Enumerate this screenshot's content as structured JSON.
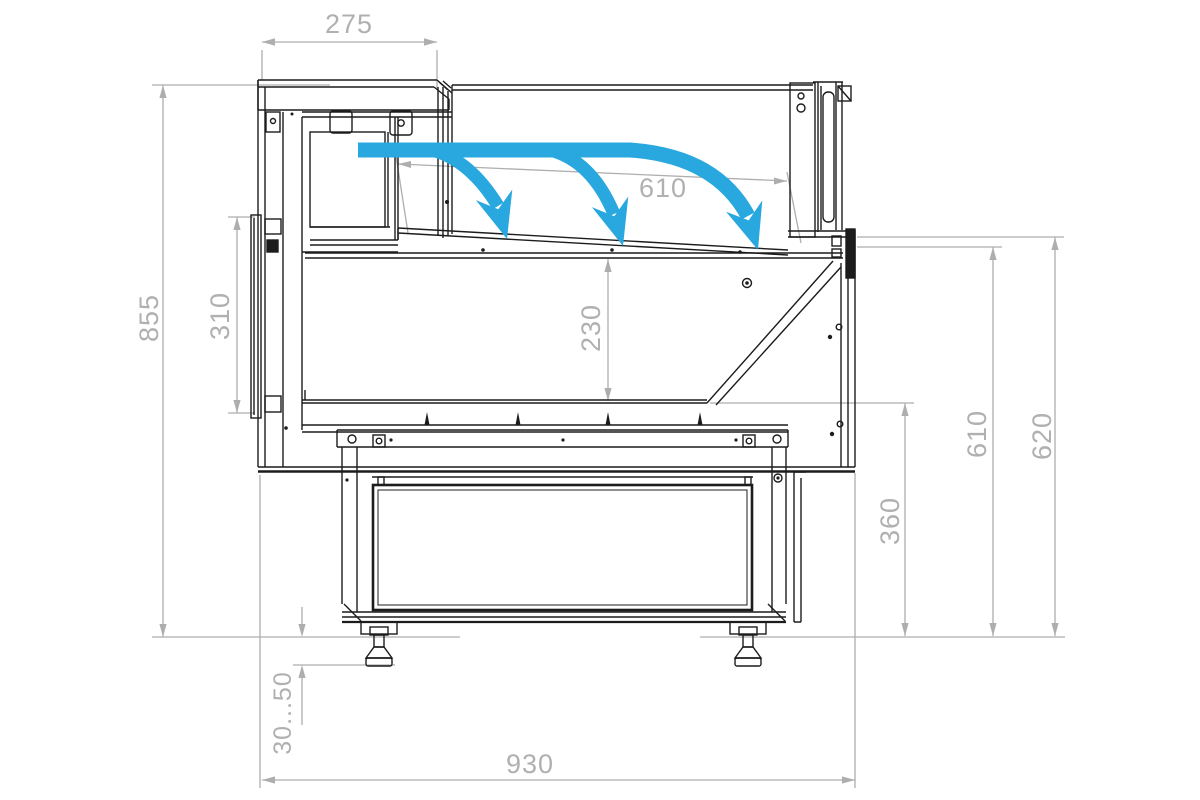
{
  "drawing": {
    "type": "technical-drawing",
    "subject": "Refrigerated serve-over display counter, side cross-section with air-curtain airflow",
    "units": "mm",
    "colors": {
      "outline": "#1c1c1c",
      "dimension": "#b0b0b0",
      "airflow": "#29a8e0",
      "background": "#ffffff"
    },
    "dimensions": {
      "canopy_depth": "275",
      "display_opening_width": "610",
      "overall_height": "855",
      "back_panel_height": "310",
      "under_deck_height": "230",
      "front_inner_height": "610",
      "front_outer_height": "620",
      "base_front_height": "360",
      "foot_adjustment_range": "30...50",
      "overall_depth": "930"
    },
    "airflow": {
      "arrow_count": 3,
      "description": "cold air curtain blown from rear canopy down onto display deck"
    }
  }
}
